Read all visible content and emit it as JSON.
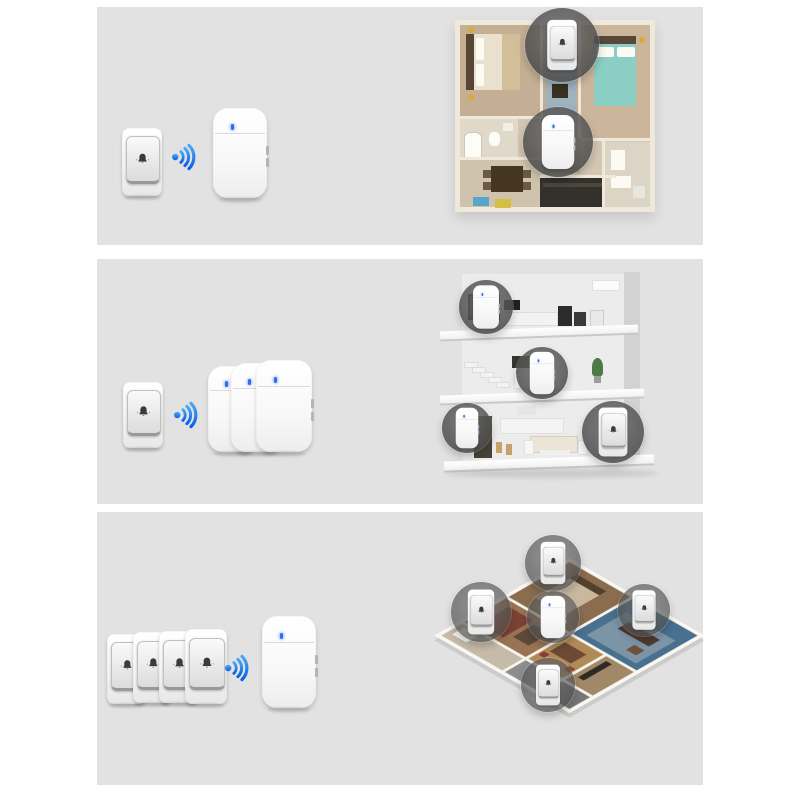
{
  "image_description": "wireless doorbell kit configuration infographic, three panels",
  "colors": {
    "page_background": "#ffffff",
    "panel_background": "#e2e2e2",
    "wifi_blue_light": "#4aa9f7",
    "wifi_blue_dark": "#0b60e4",
    "led_blue": "#2f6ef2",
    "device_white": "#fcfcfc",
    "bell_glyph": "#3b3b3b",
    "circle_overlay": "#555555"
  },
  "icons": {
    "wifi": "wifi-signal-icon",
    "bell": "bell-icon",
    "led": "led-indicator"
  },
  "panels": [
    {
      "name": "1 transmitter to 1 receiver",
      "transmitters": 1,
      "receivers": 1,
      "scene": {
        "type": "apartment-top-view-floor-plan",
        "circles": [
          {
            "device": "transmitter",
            "x": 107,
            "y": 25,
            "r": 37,
            "scale": 0.74
          },
          {
            "device": "receiver",
            "x": 103,
            "y": 122,
            "r": 35,
            "scale": 0.6
          }
        ]
      }
    },
    {
      "name": "1 transmitter to 3 receivers",
      "transmitters": 1,
      "receivers": 3,
      "scene": {
        "type": "three-story-house-cutaway",
        "circles": [
          {
            "device": "receiver",
            "x": 46,
            "y": 41,
            "r": 27,
            "scale": 0.48
          },
          {
            "device": "receiver",
            "x": 102,
            "y": 107,
            "r": 26,
            "scale": 0.47
          },
          {
            "device": "receiver",
            "x": 27,
            "y": 162,
            "r": 25,
            "scale": 0.45
          },
          {
            "device": "transmitter",
            "x": 173,
            "y": 166,
            "r": 31,
            "scale": 0.72
          }
        ]
      }
    },
    {
      "name": "4 transmitters to 1 receiver",
      "transmitters": 4,
      "receivers": 1,
      "scene": {
        "type": "isometric-3d-floor-plan",
        "circles": [
          {
            "device": "transmitter",
            "x": 125,
            "y": 48,
            "r": 28,
            "scale": 0.62
          },
          {
            "device": "transmitter",
            "x": 53,
            "y": 97,
            "r": 30,
            "scale": 0.66
          },
          {
            "device": "receiver",
            "x": 125,
            "y": 102,
            "r": 26,
            "scale": 0.47
          },
          {
            "device": "transmitter",
            "x": 216,
            "y": 95,
            "r": 26,
            "scale": 0.58
          },
          {
            "device": "transmitter",
            "x": 120,
            "y": 170,
            "r": 27,
            "scale": 0.6
          }
        ]
      }
    }
  ]
}
